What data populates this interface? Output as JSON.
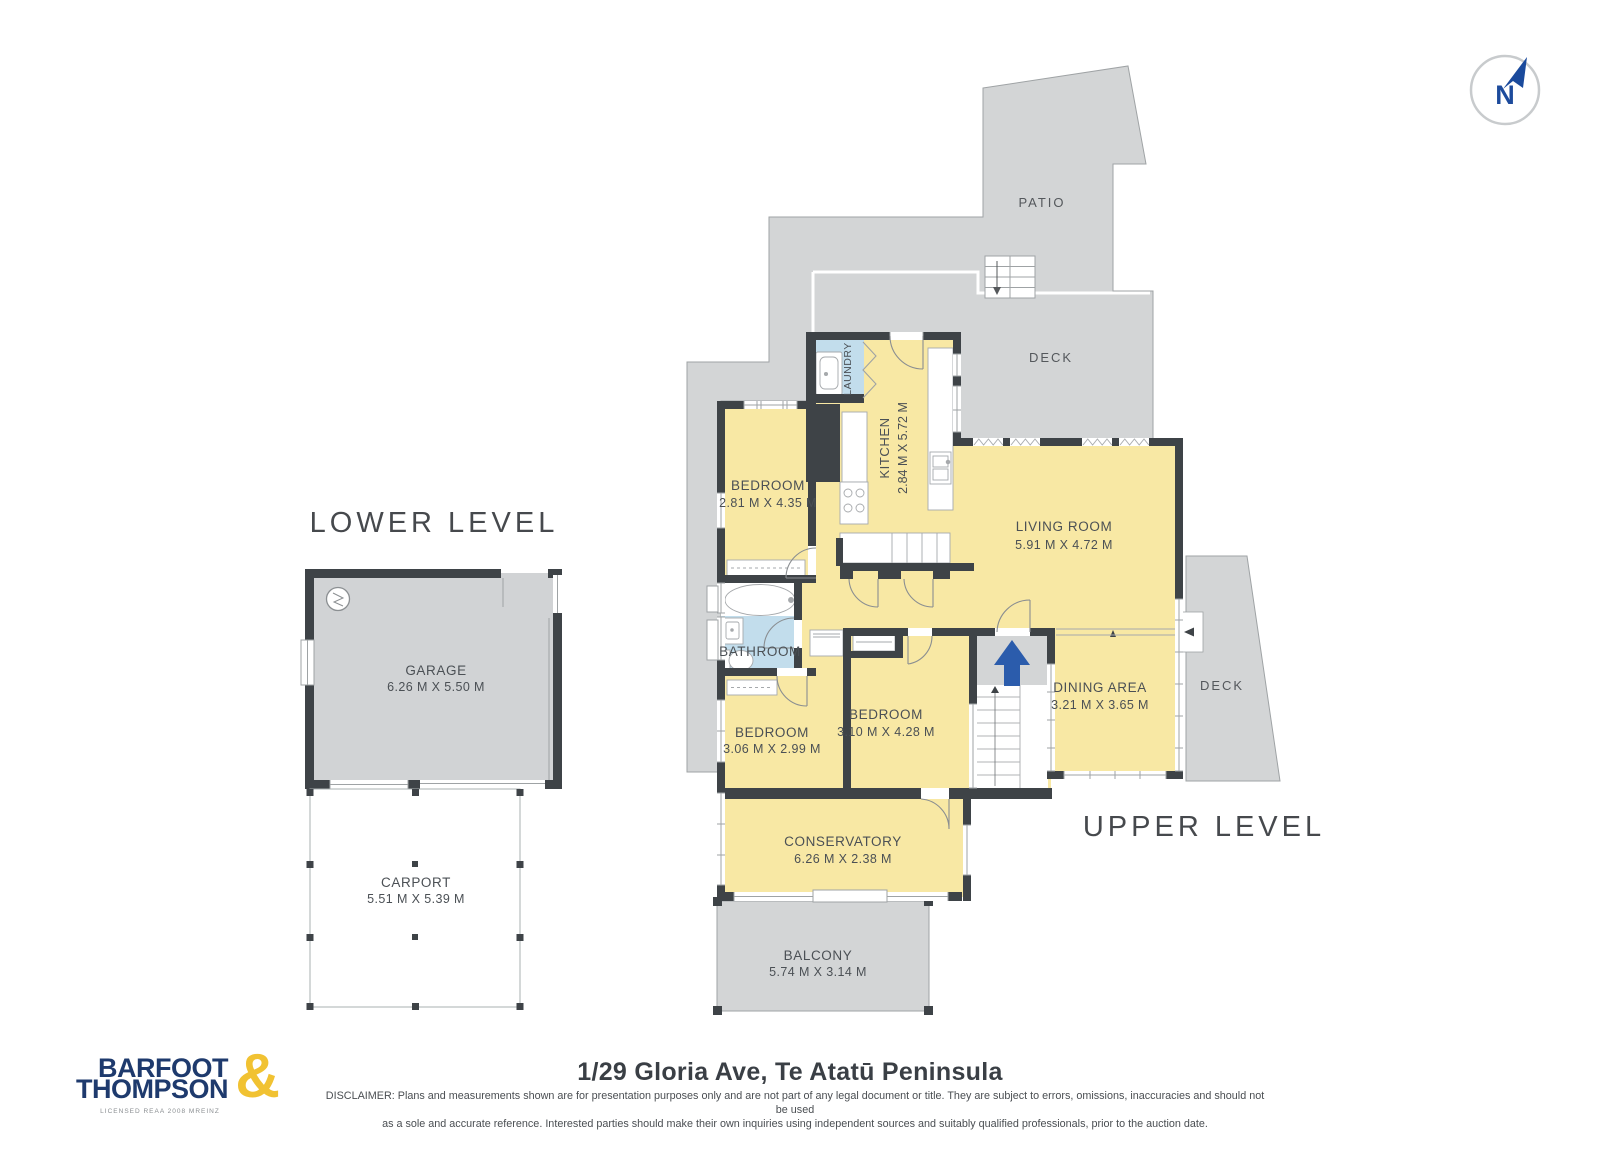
{
  "compass": {
    "label": "N"
  },
  "lower_level": {
    "title": "LOWER LEVEL",
    "garage": {
      "name": "GARAGE",
      "dims": "6.26 M X 5.50 M"
    },
    "carport": {
      "name": "CARPORT",
      "dims": "5.51 M X 5.39 M"
    }
  },
  "upper_level": {
    "title": "UPPER LEVEL",
    "patio": {
      "name": "PATIO"
    },
    "deck_top": {
      "name": "DECK"
    },
    "deck_right": {
      "name": "DECK"
    },
    "laundry": {
      "name": "LAUNDRY"
    },
    "kitchen": {
      "name": "KITCHEN",
      "dims": "2.84 M X 5.72 M"
    },
    "bedroom_top": {
      "name": "BEDROOM",
      "dims": "2.81 M X 4.35 M"
    },
    "living_room": {
      "name": "LIVING ROOM",
      "dims": "5.91 M X 4.72 M"
    },
    "bathroom": {
      "name": "BATHROOM"
    },
    "bedroom_mid": {
      "name": "BEDROOM",
      "dims": "3.06 M X 2.99 M"
    },
    "bedroom_right": {
      "name": "BEDROOM",
      "dims": "3.10 M X 4.28 M"
    },
    "dining": {
      "name": "DINING AREA",
      "dims": "3.21 M X 3.65 M"
    },
    "conservatory": {
      "name": "CONSERVATORY",
      "dims": "6.26 M X 2.38 M"
    },
    "balcony": {
      "name": "BALCONY",
      "dims": "5.74 M X 3.14 M"
    }
  },
  "footer": {
    "logo": {
      "line1": "BARFOOT",
      "line2": "THOMPSON",
      "ampersand": "&",
      "tagline": "LICENSED REAA 2008 MREINZ"
    },
    "title": "1/29 Gloria Ave, Te Atatū Peninsula",
    "disclaimer_line1": "DISCLAIMER: Plans and measurements shown are for presentation purposes only and are not part of any legal document or title. They are subject to errors, omissions, inaccuracies and should not be used",
    "disclaimer_line2": "as a sole and accurate reference. Interested parties should make their own inquiries using independent sources and suitably qualified professionals, prior to the auction date."
  },
  "colors": {
    "room_fill": "#F8E8A4",
    "outdoor_fill": "#D3D5D6",
    "wall": "#3E4347",
    "wet_room_fill": "#C2DDEC",
    "stair_arrow_blue": "#2B5CAC",
    "logo_navy": "#1E3A6D",
    "logo_gold": "#F1C232"
  }
}
